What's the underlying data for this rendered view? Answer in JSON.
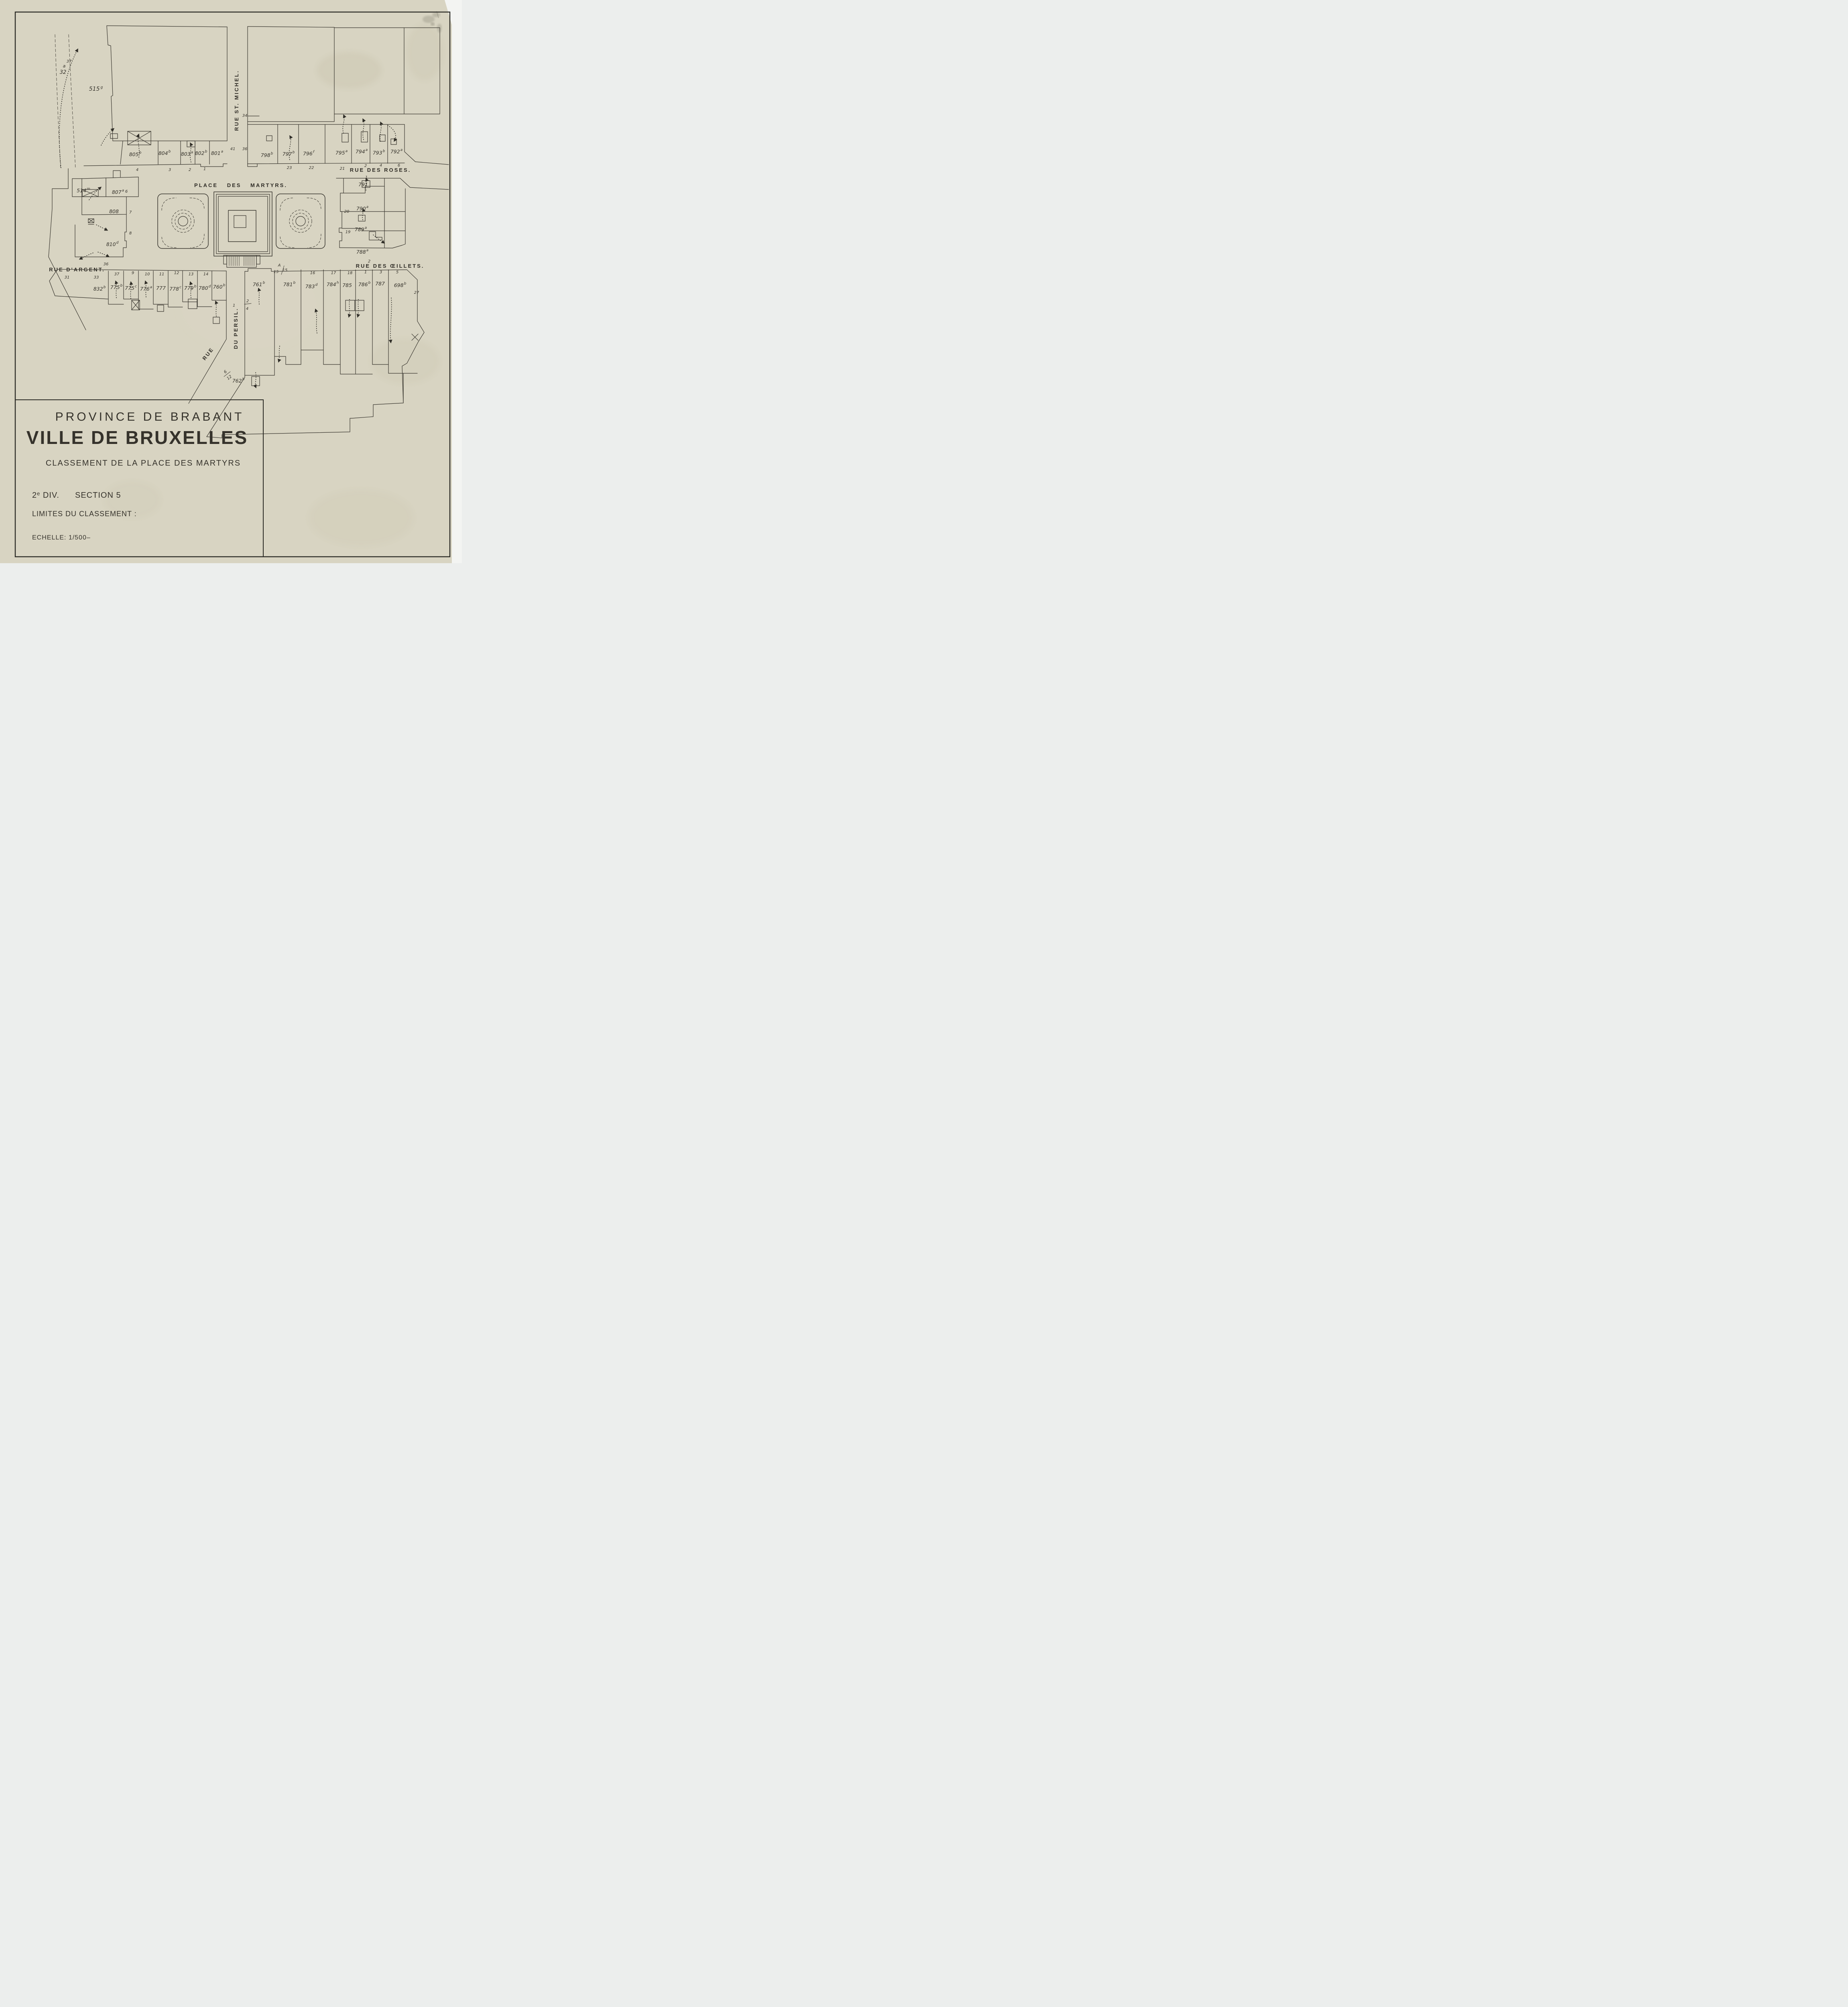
{
  "page": {
    "paper_color": "#d8d4c2",
    "ink_color": "#35322b",
    "backing_color": "#f3f4f2"
  },
  "title_block": {
    "line1": "PROVINCE DE BRABANT",
    "line2": "VILLE DE BRUXELLES",
    "line3": "CLASSEMENT  DE  LA  PLACE  DES  MARTYRS",
    "division_num": "2",
    "division_sup": "e",
    "division_rest": " DIV.",
    "section": "SECTION 5",
    "line5": "LIMITES DU CLASSEMENT :",
    "line6": "ECHELLE: 1/500–"
  },
  "streets": {
    "place": "PLACE   DES   MARTYRS.",
    "st_michel": "RUE ST. MICHEL.",
    "roses": "RUE DES ROSES.",
    "argent": "RUE D'ARGENT.",
    "oeillets": "RUE DES ŒILLETS.",
    "persil_rue": "RUE",
    "persil_du": "DU PERSIL."
  },
  "pc": {
    "p515": {
      "num": "515",
      "sup": "g"
    },
    "p514": {
      "num": "514",
      "sup": "m"
    },
    "p805": {
      "num": "805",
      "sup": "b"
    },
    "p804": {
      "num": "804",
      "sup": "b"
    },
    "p803": {
      "num": "803",
      "sup": "a"
    },
    "p802": {
      "num": "802",
      "sup": "b"
    },
    "p801": {
      "num": "801",
      "sup": "a"
    },
    "p798": {
      "num": "798",
      "sup": "b"
    },
    "p797": {
      "num": "797",
      "sup": "b"
    },
    "p796": {
      "num": "796",
      "sup": "f"
    },
    "p795": {
      "num": "795",
      "sup": "a"
    },
    "p794": {
      "num": "794",
      "sup": "a"
    },
    "p793": {
      "num": "793",
      "sup": "b"
    },
    "p792": {
      "num": "792",
      "sup": "a"
    },
    "p791": {
      "num": "791",
      "sup": ""
    },
    "p790": {
      "num": "790",
      "sup": "a"
    },
    "p789": {
      "num": "789",
      "sup": "a"
    },
    "p788": {
      "num": "788",
      "sup": "a"
    },
    "p807": {
      "num": "807",
      "sup": "a"
    },
    "p808": {
      "num": "808",
      "sup": ""
    },
    "p810": {
      "num": "810",
      "sup": "d"
    },
    "p832": {
      "num": "832",
      "sup": "b"
    },
    "p775b": {
      "num": "775",
      "sup": "b"
    },
    "p775c": {
      "num": "775",
      "sup": "c"
    },
    "p776": {
      "num": "776",
      "sup": "a"
    },
    "p777": {
      "num": "777",
      "sup": ""
    },
    "p778": {
      "num": "778",
      "sup": "c"
    },
    "p779": {
      "num": "779",
      "sup": "b"
    },
    "p780": {
      "num": "780",
      "sup": "d"
    },
    "p760": {
      "num": "760",
      "sup": "b"
    },
    "p761": {
      "num": "761",
      "sup": "b"
    },
    "p781": {
      "num": "781",
      "sup": "b"
    },
    "p783": {
      "num": "783",
      "sup": "d"
    },
    "p784": {
      "num": "784",
      "sup": "h"
    },
    "p785": {
      "num": "785",
      "sup": ""
    },
    "p786": {
      "num": "786",
      "sup": "b"
    },
    "p787": {
      "num": "787",
      "sup": ""
    },
    "p698": {
      "num": "698",
      "sup": "b"
    },
    "p762": {
      "num": "762",
      "sup": "h"
    }
  },
  "hn": {
    "t37": "37",
    "ta": "a",
    "t32": "32",
    "h4": "4",
    "h3": "3",
    "h2": "2",
    "h1": "1",
    "h41": "41",
    "h36": "36",
    "h34": "34",
    "h23": "23",
    "h22": "22",
    "h21": "21",
    "r2": "2",
    "r4": "4",
    "r6": "6",
    "r1": "1",
    "e20": "20",
    "e19": "19",
    "o2": "2",
    "o18": "18",
    "o1": "1",
    "o3": "3",
    "o5": "5",
    "o16": "16",
    "o17": "17",
    "pA": "A",
    "p15l": "15",
    "p15r": "15",
    "a36": "36",
    "a31": "31",
    "a33": "33",
    "a37": "37",
    "w9": "9",
    "w10": "10",
    "w11": "11",
    "w12": "12",
    "w13": "13",
    "w14": "14",
    "n27": "27",
    "p1": "1",
    "f2": "2",
    "f4": "4",
    "f6": "6",
    "f12": "12",
    "s6": "6",
    "s7": "7",
    "s8": "8"
  }
}
